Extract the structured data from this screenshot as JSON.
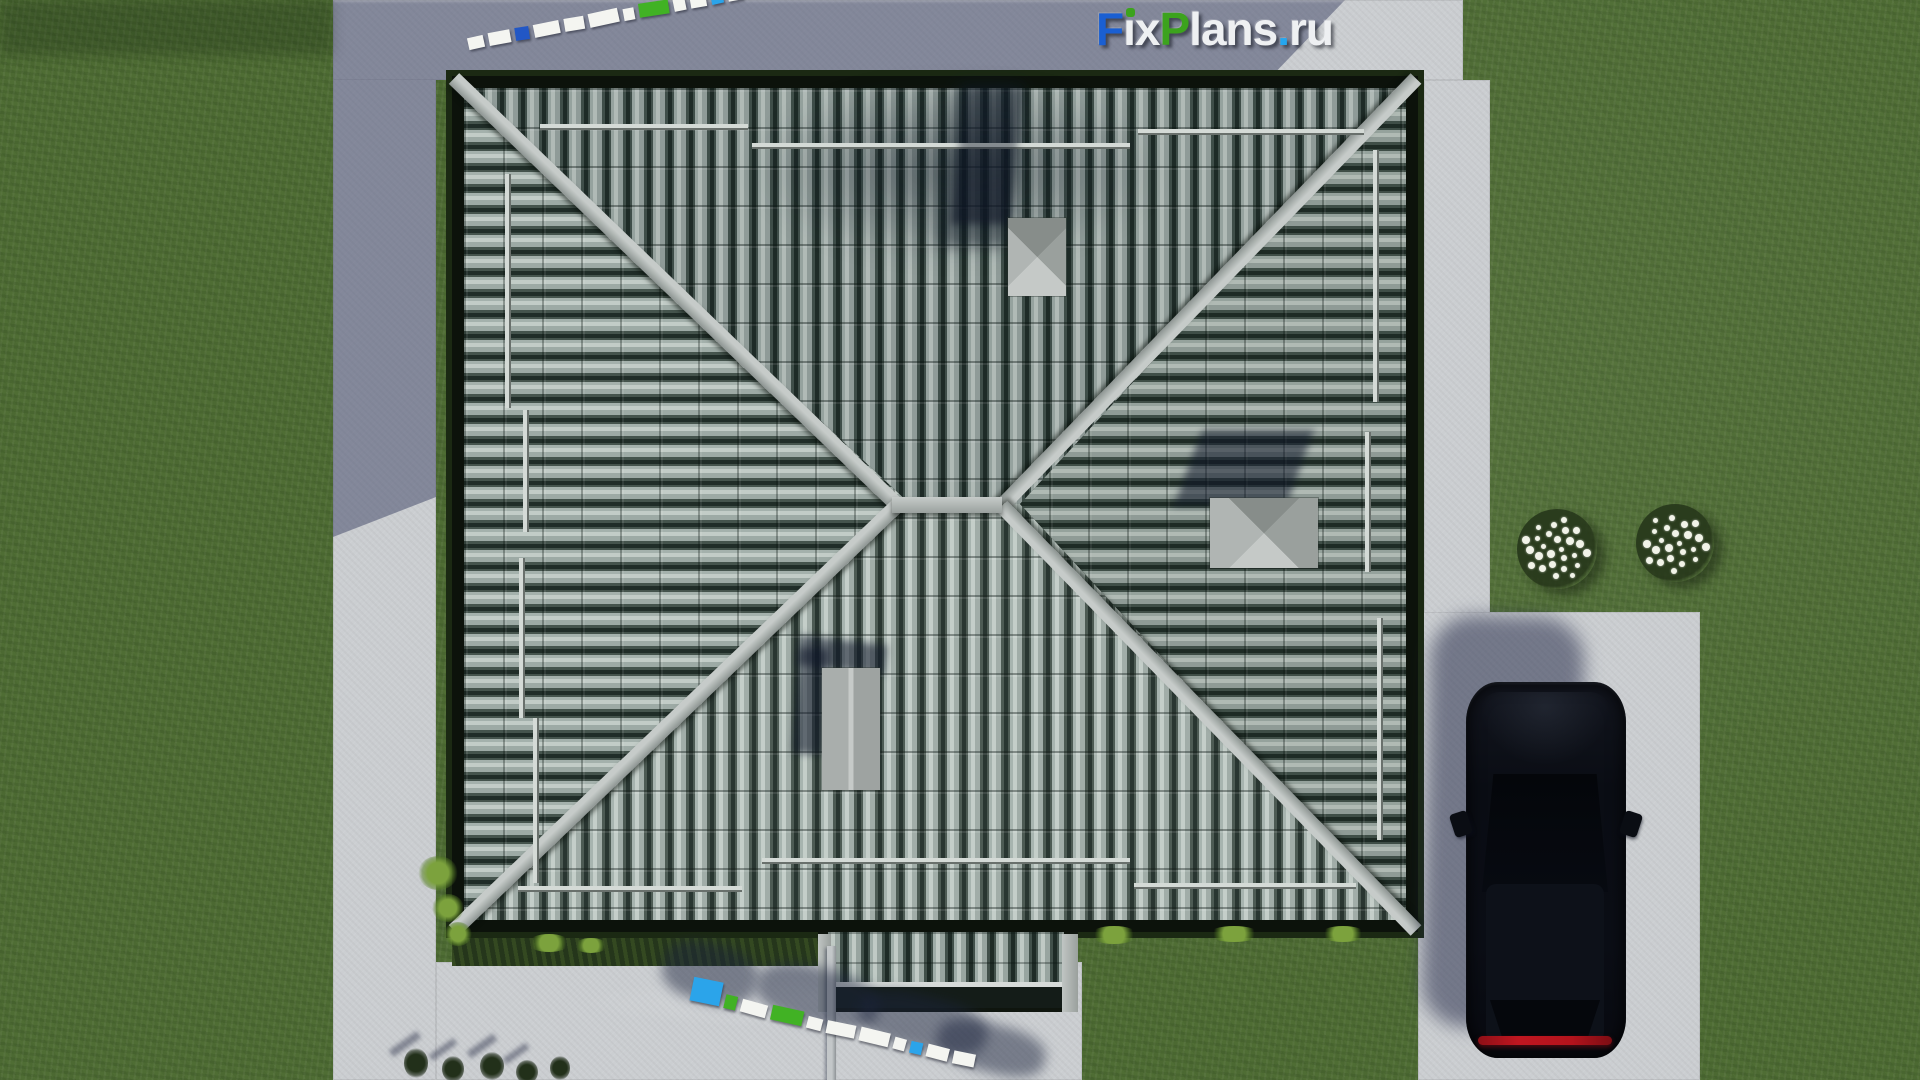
{
  "brand": {
    "name": "FixPlans.ru",
    "parts": [
      {
        "t": "F",
        "color": "#1a5fd2"
      },
      {
        "t": "ı",
        "color": "#eef0f2",
        "dot": "#3ca31d"
      },
      {
        "t": "x",
        "color": "#eef0f2"
      },
      {
        "t": "P",
        "color": "#3ca31d"
      },
      {
        "t": "lans",
        "color": "#eef0f2"
      },
      {
        "t": ".",
        "color": "#25a6ef"
      },
      {
        "t": "ru",
        "color": "#eef0f2"
      }
    ]
  },
  "palette": {
    "white": "#f4f5f1",
    "blue_dark": "#2257c5",
    "blue_light": "#2ba4ea",
    "green": "#41b224",
    "grass": "#4f6d34",
    "concrete": "#cbced1",
    "roof_tile_light": "#c2ccc7",
    "roof_tile_dark": "#202d28",
    "ridge": "#a8afac",
    "car_body": "#0b0e16",
    "taillight_red": "#b3131c"
  },
  "watermarks": {
    "top": {
      "blocks": [
        {
          "w": 16,
          "h": 12,
          "c": "white"
        },
        {
          "w": 22,
          "h": 13,
          "c": "white"
        },
        {
          "w": 14,
          "h": 13,
          "c": "blue_dark"
        },
        {
          "w": 26,
          "h": 13,
          "c": "white"
        },
        {
          "w": 20,
          "h": 13,
          "c": "white"
        },
        {
          "w": 30,
          "h": 14,
          "c": "white"
        },
        {
          "w": 11,
          "h": 12,
          "c": "white"
        },
        {
          "w": 30,
          "h": 14,
          "c": "green"
        },
        {
          "w": 12,
          "h": 12,
          "c": "white"
        },
        {
          "w": 16,
          "h": 12,
          "c": "white"
        },
        {
          "w": 12,
          "h": 12,
          "c": "blue_light"
        },
        {
          "w": 15,
          "h": 12,
          "c": "white"
        }
      ]
    },
    "bottom": {
      "blocks": [
        {
          "w": 30,
          "h": 24,
          "c": "blue_light"
        },
        {
          "w": 12,
          "h": 14,
          "c": "green"
        },
        {
          "w": 26,
          "h": 13,
          "c": "white"
        },
        {
          "w": 32,
          "h": 15,
          "c": "green"
        },
        {
          "w": 15,
          "h": 12,
          "c": "white"
        },
        {
          "w": 29,
          "h": 13,
          "c": "white"
        },
        {
          "w": 30,
          "h": 14,
          "c": "white"
        },
        {
          "w": 12,
          "h": 12,
          "c": "white"
        },
        {
          "w": 12,
          "h": 12,
          "c": "blue_light"
        },
        {
          "w": 22,
          "h": 13,
          "c": "white"
        },
        {
          "w": 22,
          "h": 13,
          "c": "white"
        }
      ]
    }
  },
  "bushes": [
    {
      "flowers": 26
    },
    {
      "flowers": 23
    }
  ]
}
